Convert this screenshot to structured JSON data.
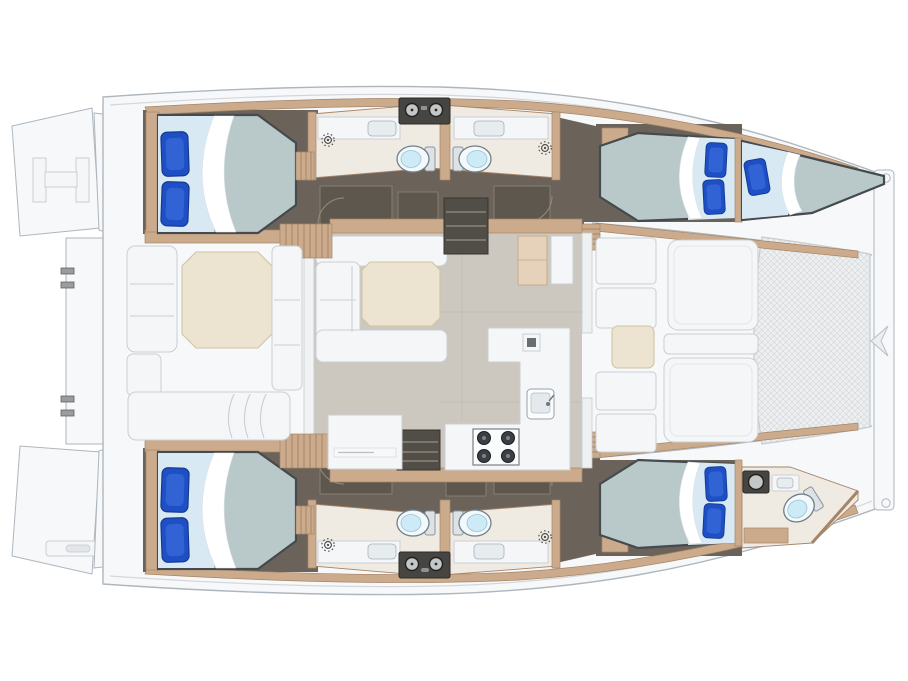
{
  "diagram": {
    "type": "catamaran-yacht-deck-plan",
    "orientation": {
      "bow": "right",
      "stern": "left",
      "port_hull": "top",
      "starboard_hull": "bottom"
    },
    "counts": {
      "double_berths": 4,
      "forepeak_berths": 1,
      "toilets": 5,
      "shower_drains": 4,
      "stove_burners": 4
    },
    "areas": {
      "port_hull": [
        "cabin-aft-port",
        "head-port-aft",
        "head-port-forward",
        "cabin-forward-port",
        "skipper-berth-port-bow"
      ],
      "starboard_hull": [
        "cabin-aft-starboard",
        "head-starboard-aft",
        "head-starboard-forward",
        "cabin-forward-starboard",
        "head-starboard-bow"
      ],
      "bridgedeck": [
        "aft-cockpit",
        "salon",
        "galley",
        "nav-table",
        "forward-cockpit",
        "trampoline"
      ],
      "stern": [
        "swim-platform-port",
        "swim-platform-starboard",
        "boarding-ladder",
        "transom-steps"
      ]
    },
    "salon_features": [
      "l-shaped-sofa",
      "dining-table",
      "galley-counter",
      "four-burner-stove",
      "galley-sink",
      "fridge-cabinet",
      "companionway-steps-port",
      "companionway-steps-starboard"
    ],
    "cockpit_features": [
      "octagonal-cockpit-table",
      "bench-seating",
      "aft-bench"
    ],
    "foredeck_features": [
      "lounge-pad-port",
      "lounge-pad-starboard",
      "foredeck-table",
      "trampoline-net",
      "forward-crossbeam",
      "bowsprit-fitting"
    ]
  },
  "colors": {
    "c-bg": "#ffffff",
    "c-deck": "#f7f8f9",
    "c-deck-stroke": "#aeb6bd",
    "c-deck-line": "#d3d7db",
    "c-furn": "#f5f6f8",
    "c-furn-stroke": "#c9cfd4",
    "c-floor-dark": "#6b6359",
    "c-bath": "#efebe3",
    "c-wood": "#ccab8d",
    "c-wood-dark": "#a58568",
    "c-salon": "#cdc8bf",
    "c-mattress": "#b9c8c9",
    "c-frame": "#454a4e",
    "c-sheet": "#d9e9f3",
    "c-pillow": "#1e4fc4",
    "c-pillow-dark": "#133a92",
    "c-pillow-hi": "#3566d8",
    "c-table": "#ece4d1",
    "c-table-stroke": "#cfc4a6",
    "c-ward": "#5e574e",
    "c-steps": "#514d47",
    "c-tread": "#8b8478",
    "c-panel": "#474542",
    "c-panel-circle": "#c3c7c8",
    "c-toilet": "#f3f8fa",
    "c-toilet-stroke": "#70808a",
    "c-toilet-inner": "#cdeaf7",
    "c-tramp": "#edeff0",
    "c-tramp-line": "#d7dadd",
    "c-burner": "#3b3f44"
  }
}
